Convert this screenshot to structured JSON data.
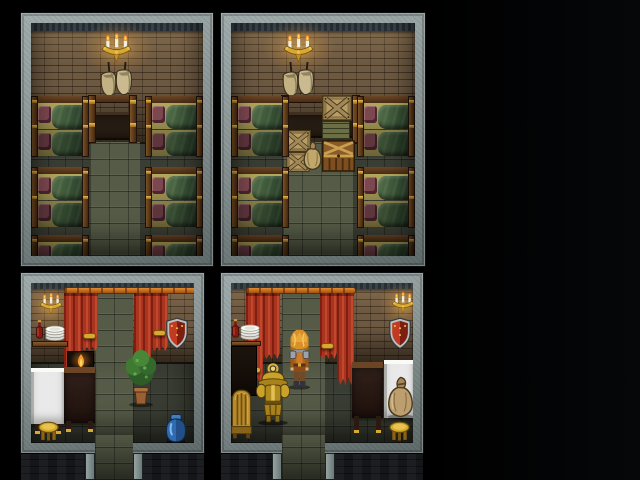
{
  "scene": {
    "title": "Four-room inn interior — overhead RPG view",
    "style": "16-bit RPG tileset, night interior on black backdrop",
    "background": "#000000",
    "rooms": [
      {
        "id": "bunkhouse-left",
        "position": "top-left",
        "walls": "brown brick",
        "floor": "dark stone tiles with light center aisle",
        "furniture": [
          "wall-candelabra",
          "hanging-sacks",
          "wooden-desk",
          "bunk-beds x6"
        ]
      },
      {
        "id": "bunkhouse-right",
        "position": "top-right",
        "walls": "brown brick",
        "floor": "dark stone tiles with light center aisle",
        "furniture": [
          "wall-candelabra",
          "hanging-sacks",
          "wooden-desk",
          "x-crates x3",
          "slat-crate",
          "small-sack",
          "storage-chest",
          "bunk-beds x6"
        ]
      },
      {
        "id": "common-room-left",
        "position": "bottom-left",
        "walls": "brown brick",
        "floor": "dark stone tiles",
        "furniture": [
          "wall-sconce",
          "curtain-rod",
          "red-curtain-pair x2",
          "wall-shelf",
          "wine-bottle",
          "plate-stack",
          "heater-shield",
          "fireplace",
          "dark-wood-table",
          "white-cloth-table",
          "potted-plant",
          "gold-stool",
          "blue-jar"
        ],
        "exits": [
          "north-doorway",
          "south-doorway"
        ]
      },
      {
        "id": "common-room-right",
        "position": "bottom-right",
        "walls": "brown brick",
        "floor": "dark stone tiles",
        "furniture": [
          "wall-sconce",
          "curtain-rod",
          "red-curtain-pair x2",
          "side-cabinet",
          "wine-bottle",
          "plate-stack",
          "heater-shield",
          "golden-armor-stand",
          "wooden-chair",
          "dark-wood-table",
          "white-cloth-table",
          "grain-sack",
          "gold-stool"
        ],
        "exits": [
          "north-doorway",
          "south-doorway"
        ]
      }
    ],
    "character": {
      "id": "player",
      "description": "adventurer with spiky blond hair, steel pauldrons, orange tunic, facing north",
      "room": "common-room-right",
      "tile": "north doorway column"
    },
    "beds": [
      {
        "room": "tl",
        "x": 0,
        "y": 73
      },
      {
        "room": "tl",
        "x": 114,
        "y": 73
      },
      {
        "room": "tl",
        "x": 0,
        "y": 144
      },
      {
        "room": "tl",
        "x": 114,
        "y": 144
      },
      {
        "room": "tl",
        "x": 0,
        "y": 212
      },
      {
        "room": "tl",
        "x": 114,
        "y": 212
      },
      {
        "room": "tr",
        "x": 0,
        "y": 73
      },
      {
        "room": "tr",
        "x": 126,
        "y": 73
      },
      {
        "room": "tr",
        "x": 0,
        "y": 144
      },
      {
        "room": "tr",
        "x": 126,
        "y": 144
      },
      {
        "room": "tr",
        "x": 0,
        "y": 212
      },
      {
        "room": "tr",
        "x": 126,
        "y": 212
      }
    ],
    "palette": {
      "frame_stone": "#8a9494",
      "wall_brick": "#6d5942",
      "floor_dark": "#3a3d33",
      "floor_light": "#565b47",
      "curtain_red": "#a93420",
      "curtain_shadow": "#7e1f10",
      "rod_orange": "#e08a30",
      "gold_trim": "#d8a830",
      "blanket_green": "#3f5a3a",
      "pillow_maroon": "#7c4850",
      "sheet_tan": "#b2a75e",
      "wood_dark": "#5e3c1e",
      "crate_tan": "#b89c64",
      "shield_red": "#b33222",
      "vase_blue": "#2f6bb0",
      "cloth_white": "#e9e9e9",
      "hair_blond": "#e29a2c",
      "armor_gold": "#c9a22a"
    }
  }
}
